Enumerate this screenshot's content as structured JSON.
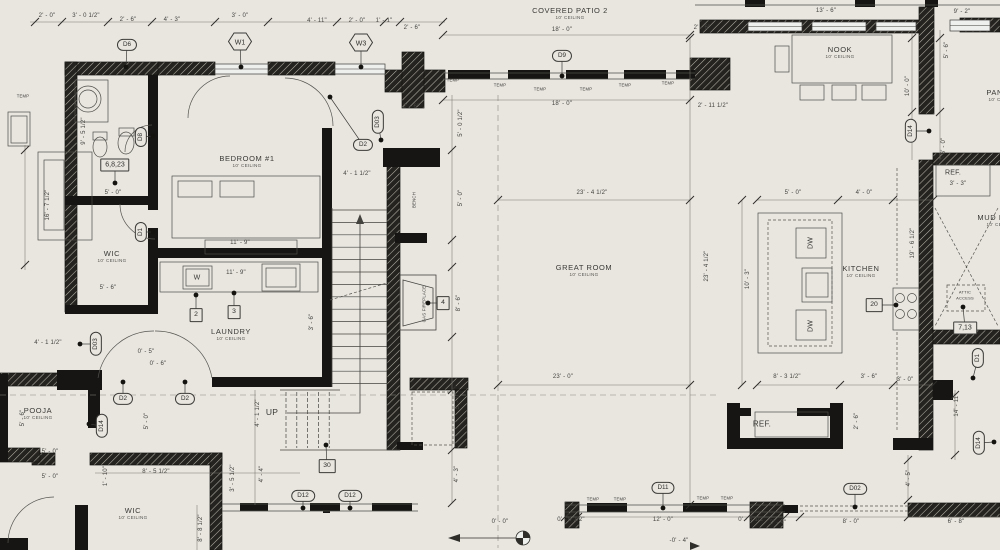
{
  "palette": {
    "paper": "#e9e6e0",
    "ink": "#3a3935",
    "wall": "#161513",
    "dimline": "#6a685f",
    "accent": "#2f2e2a"
  },
  "title": "floor-plan-sheet",
  "rooms": [
    {
      "name": "COVERED PATIO 2",
      "ceiling": "10' CEILING",
      "x": 570,
      "y": 13
    },
    {
      "name": "NOOK",
      "ceiling": "10' CEILING",
      "x": 840,
      "y": 52
    },
    {
      "name": "BEDROOM #1",
      "ceiling": "10' CEILING",
      "x": 247,
      "y": 161
    },
    {
      "name": "WIC",
      "ceiling": "10' CEILING",
      "x": 112,
      "y": 256
    },
    {
      "name": "LAUNDRY",
      "ceiling": "10' CEILING",
      "x": 231,
      "y": 334
    },
    {
      "name": "POOJA",
      "ceiling": "10' CEILING",
      "x": 38,
      "y": 413
    },
    {
      "name": "WIC",
      "ceiling": "10' CEILING",
      "x": 133,
      "y": 513
    },
    {
      "name": "GREAT ROOM",
      "ceiling": "10' CEILING",
      "x": 584,
      "y": 270
    },
    {
      "name": "KITCHEN",
      "ceiling": "10' CEILING",
      "x": 861,
      "y": 271
    },
    {
      "name": "PANTRY",
      "ceiling": "10' CEILING",
      "x": 1003,
      "y": 95
    },
    {
      "name": "MUD ROOM",
      "ceiling": "10' CEILING",
      "x": 1001,
      "y": 220
    }
  ],
  "dims": [
    {
      "t": "2' - 0\"",
      "x": 47,
      "y": 16
    },
    {
      "t": "3' - 0 1/2\"",
      "x": 86,
      "y": 16
    },
    {
      "t": "2' - 6\"",
      "x": 128,
      "y": 20
    },
    {
      "t": "4' - 3\"",
      "x": 172,
      "y": 20
    },
    {
      "t": "3' - 0\"",
      "x": 240,
      "y": 16
    },
    {
      "t": "4' - 11\"",
      "x": 317,
      "y": 21
    },
    {
      "t": "2' - 0\"",
      "x": 357,
      "y": 21
    },
    {
      "t": "1' - 1\"",
      "x": 384,
      "y": 21
    },
    {
      "t": "2' - 6\"",
      "x": 412,
      "y": 28
    },
    {
      "t": "2' - 6\"",
      "x": 411,
      "y": 107
    },
    {
      "t": "18' - 0\"",
      "x": 562,
      "y": 30
    },
    {
      "t": "18' - 0\"",
      "x": 562,
      "y": 104
    },
    {
      "t": "2' - 6\"",
      "x": 702,
      "y": 28
    },
    {
      "t": "2' - 11 1/2\"",
      "x": 713,
      "y": 106
    },
    {
      "t": "13' - 6\"",
      "x": 826,
      "y": 11
    },
    {
      "t": "9' - 2\"",
      "x": 962,
      "y": 12
    },
    {
      "t": "23' - 4 1/2\"",
      "x": 592,
      "y": 193
    },
    {
      "t": "23' - 0\"",
      "x": 563,
      "y": 377
    },
    {
      "t": "23' - 4 1/2\"",
      "x": 707,
      "y": 266,
      "r": 1
    },
    {
      "t": "10' - 3\"",
      "x": 748,
      "y": 279,
      "r": 1
    },
    {
      "t": "5' - 0\"",
      "x": 793,
      "y": 193
    },
    {
      "t": "4' - 0\"",
      "x": 864,
      "y": 193
    },
    {
      "t": "8' - 3 1/2\"",
      "x": 787,
      "y": 377
    },
    {
      "t": "3' - 6\"",
      "x": 869,
      "y": 377
    },
    {
      "t": "3' - 0\"",
      "x": 905,
      "y": 380
    },
    {
      "t": "19' - 6 1/2\"",
      "x": 913,
      "y": 243,
      "r": 1
    },
    {
      "t": "10' - 0\"",
      "x": 908,
      "y": 86,
      "r": 1
    },
    {
      "t": "5' - 6\"",
      "x": 947,
      "y": 50,
      "r": 1
    },
    {
      "t": "6' - 0\"",
      "x": 944,
      "y": 146,
      "r": 1
    },
    {
      "t": "3' - 3\"",
      "x": 958,
      "y": 184
    },
    {
      "t": "16' - 7 1/2\"",
      "x": 48,
      "y": 205,
      "r": 1
    },
    {
      "t": "9' - 5 1/2\"",
      "x": 84,
      "y": 131,
      "r": 1
    },
    {
      "t": "5' - 0\"",
      "x": 113,
      "y": 193
    },
    {
      "t": "5' - 6\"",
      "x": 108,
      "y": 288
    },
    {
      "t": "11' - 9\"",
      "x": 240,
      "y": 243
    },
    {
      "t": "11' - 9\"",
      "x": 236,
      "y": 273
    },
    {
      "t": "4' - 1 1/2\"",
      "x": 357,
      "y": 174
    },
    {
      "t": "5' - 0 1/2\"",
      "x": 461,
      "y": 123,
      "r": 1
    },
    {
      "t": "5' - 0\"",
      "x": 461,
      "y": 198,
      "r": 1
    },
    {
      "t": "8' - 6\"",
      "x": 459,
      "y": 303,
      "r": 1
    },
    {
      "t": "5' - 0\"",
      "x": 458,
      "y": 401,
      "r": 1
    },
    {
      "t": "4' - 3\"",
      "x": 457,
      "y": 474,
      "r": 1
    },
    {
      "t": "4' - 1 1/2\"",
      "x": 258,
      "y": 413,
      "r": 1
    },
    {
      "t": "4' - 4\"",
      "x": 262,
      "y": 474,
      "r": 1
    },
    {
      "t": "3' - 5 1/2\"",
      "x": 233,
      "y": 478,
      "r": 1
    },
    {
      "t": "8' - 8 1/2\"",
      "x": 201,
      "y": 528,
      "r": 1
    },
    {
      "t": "1' - 10\"",
      "x": 106,
      "y": 476,
      "r": 1
    },
    {
      "t": "8' - 5 1/2\"",
      "x": 156,
      "y": 472
    },
    {
      "t": "5' - 0\"",
      "x": 50,
      "y": 452
    },
    {
      "t": "5' - 0\"",
      "x": 50,
      "y": 477
    },
    {
      "t": "5' - 6\"",
      "x": 23,
      "y": 418,
      "r": 1
    },
    {
      "t": "5' - 0\"",
      "x": 147,
      "y": 421,
      "r": 1
    },
    {
      "t": "4' - 1 1/2\"",
      "x": 48,
      "y": 343
    },
    {
      "t": "0' - 5\"",
      "x": 146,
      "y": 352
    },
    {
      "t": "0' - 6\"",
      "x": 158,
      "y": 364
    },
    {
      "t": "3' - 6\"",
      "x": 312,
      "y": 322,
      "r": 1
    },
    {
      "t": "0' - 6 1/2\"",
      "x": 571,
      "y": 520
    },
    {
      "t": "12' - 0\"",
      "x": 663,
      "y": 520
    },
    {
      "t": "0' - 6 1/2\"",
      "x": 752,
      "y": 520
    },
    {
      "t": "2' - 4\"",
      "x": 778,
      "y": 523
    },
    {
      "t": "8' - 0\"",
      "x": 851,
      "y": 522
    },
    {
      "t": "6' - 8\"",
      "x": 956,
      "y": 522
    },
    {
      "t": "0' - 0\"",
      "x": 500,
      "y": 522
    },
    {
      "t": "-0' - 4\"",
      "x": 679,
      "y": 541
    },
    {
      "t": "2' - 6\"",
      "x": 857,
      "y": 421,
      "r": 1
    },
    {
      "t": "4' - 5\"",
      "x": 909,
      "y": 478,
      "r": 1
    },
    {
      "t": "14' - 11\"",
      "x": 957,
      "y": 405,
      "r": 1
    }
  ],
  "tags": [
    {
      "t": "D6",
      "s": "oval",
      "x": 127,
      "y": 45,
      "dx": 126,
      "dy": 67
    },
    {
      "t": "D9",
      "s": "oval",
      "x": 562,
      "y": 56,
      "dx": 562,
      "dy": 76
    },
    {
      "t": "D2",
      "s": "oval",
      "x": 363,
      "y": 145,
      "dx": 330,
      "dy": 97
    },
    {
      "t": "D2",
      "s": "oval",
      "x": 123,
      "y": 399,
      "dx": 123,
      "dy": 382
    },
    {
      "t": "D2",
      "s": "oval",
      "x": 185,
      "y": 399,
      "dx": 185,
      "dy": 382
    },
    {
      "t": "D12",
      "s": "oval",
      "x": 303,
      "y": 496,
      "dx": 303,
      "dy": 508
    },
    {
      "t": "D12",
      "s": "oval",
      "x": 350,
      "y": 496,
      "dx": 350,
      "dy": 508
    },
    {
      "t": "D11",
      "s": "oval",
      "x": 663,
      "y": 488,
      "dx": 663,
      "dy": 508
    },
    {
      "t": "D02",
      "s": "oval",
      "x": 855,
      "y": 489,
      "dx": 855,
      "dy": 507
    },
    {
      "t": "D03",
      "s": "ovalr",
      "x": 378,
      "y": 122,
      "dx": 381,
      "dy": 140
    },
    {
      "t": "D8",
      "s": "ovalr",
      "x": 141,
      "y": 137,
      "dx": 153,
      "dy": 136
    },
    {
      "t": "D1",
      "s": "ovalr",
      "x": 141,
      "y": 232,
      "dx": 153,
      "dy": 232
    },
    {
      "t": "D03",
      "s": "ovalr",
      "x": 96,
      "y": 344,
      "dx": 80,
      "dy": 344
    },
    {
      "t": "D14",
      "s": "ovalr",
      "x": 102,
      "y": 426,
      "dx": 89,
      "dy": 424
    },
    {
      "t": "D14",
      "s": "ovalr",
      "x": 911,
      "y": 131,
      "dx": 929,
      "dy": 131
    },
    {
      "t": "D1",
      "s": "ovalr",
      "x": 978,
      "y": 358,
      "dx": 973,
      "dy": 378
    },
    {
      "t": "D14",
      "s": "ovalr",
      "x": 979,
      "y": 443,
      "dx": 994,
      "dy": 442
    },
    {
      "t": "W1",
      "s": "hex",
      "x": 240,
      "y": 44,
      "dx": 241,
      "dy": 67
    },
    {
      "t": "W3",
      "s": "hex",
      "x": 361,
      "y": 45,
      "dx": 361,
      "dy": 67
    },
    {
      "t": "2",
      "s": "box",
      "x": 196,
      "y": 315,
      "dx": 196,
      "dy": 295
    },
    {
      "t": "3",
      "s": "box",
      "x": 234,
      "y": 312,
      "dx": 234,
      "dy": 293
    },
    {
      "t": "4",
      "s": "box",
      "x": 443,
      "y": 303,
      "dx": 428,
      "dy": 303
    },
    {
      "t": "20",
      "s": "box",
      "x": 874,
      "y": 305,
      "dx": 896,
      "dy": 305
    },
    {
      "t": "30",
      "s": "box",
      "x": 327,
      "y": 466,
      "dx": 326,
      "dy": 445
    },
    {
      "t": "6,8,23",
      "s": "rbox",
      "x": 115,
      "y": 165,
      "dx": 115,
      "dy": 183
    },
    {
      "t": "7,13",
      "s": "rbox",
      "x": 965,
      "y": 328,
      "dx": 963,
      "dy": 307
    }
  ],
  "notes": [
    {
      "t": "TEMP",
      "x": 23,
      "y": 96,
      "size": 4.2
    },
    {
      "t": "TEMP",
      "x": 453,
      "y": 80,
      "size": 4.2
    },
    {
      "t": "TEMP",
      "x": 500,
      "y": 85,
      "size": 4.2
    },
    {
      "t": "TEMP",
      "x": 540,
      "y": 89,
      "size": 4.2
    },
    {
      "t": "TEMP",
      "x": 586,
      "y": 89,
      "size": 4.2
    },
    {
      "t": "TEMP",
      "x": 625,
      "y": 85,
      "size": 4.2
    },
    {
      "t": "TEMP",
      "x": 668,
      "y": 83,
      "size": 4.2
    },
    {
      "t": "TEMP",
      "x": 593,
      "y": 499,
      "size": 4.2
    },
    {
      "t": "TEMP",
      "x": 620,
      "y": 499,
      "size": 4.2
    },
    {
      "t": "TEMP",
      "x": 703,
      "y": 498,
      "size": 4.2
    },
    {
      "t": "TEMP",
      "x": 727,
      "y": 498,
      "size": 4.2
    },
    {
      "t": "W",
      "x": 197,
      "y": 278,
      "size": 7
    },
    {
      "t": "DW",
      "x": 811,
      "y": 243,
      "r": 1,
      "size": 7
    },
    {
      "t": "DW",
      "x": 811,
      "y": 326,
      "r": 1,
      "size": 7
    },
    {
      "t": "REF.",
      "x": 953,
      "y": 173,
      "size": 7
    },
    {
      "t": "REF.",
      "x": 762,
      "y": 424,
      "size": 8
    },
    {
      "t": "UP",
      "x": 272,
      "y": 412,
      "size": 8.5
    },
    {
      "t": "GAS FIREPLACE",
      "x": 424,
      "y": 304,
      "r": 1,
      "size": 4.3
    },
    {
      "t": "BENCH",
      "x": 414,
      "y": 200,
      "r": 1,
      "size": 4.3
    },
    {
      "t": "ATTIC",
      "x": 965,
      "y": 292,
      "size": 4
    },
    {
      "t": "ACCESS",
      "x": 965,
      "y": 298,
      "size": 4
    }
  ]
}
